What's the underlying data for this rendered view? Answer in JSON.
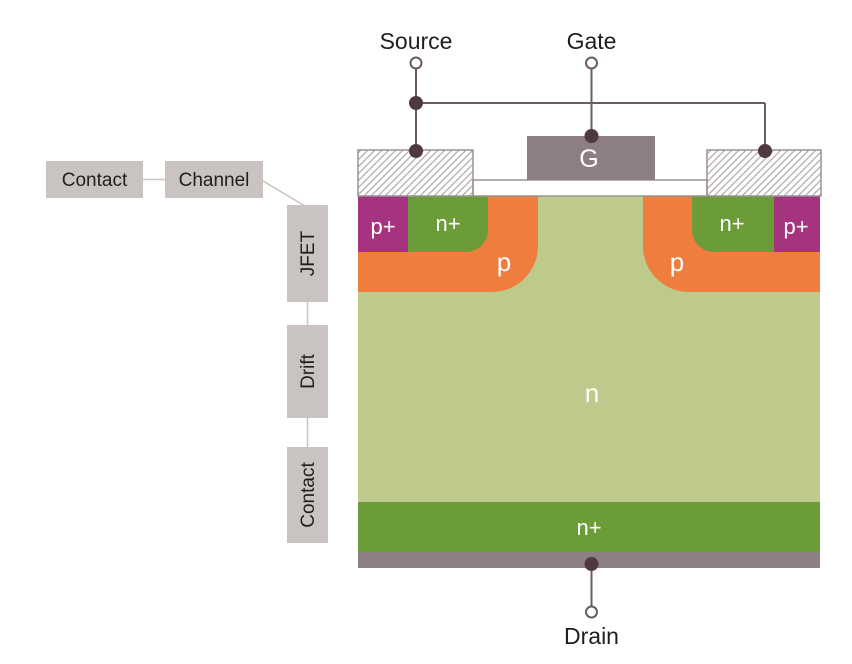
{
  "diagram": {
    "terminals": {
      "source": {
        "label": "Source"
      },
      "gate": {
        "label": "Gate",
        "electrode_label": "G"
      },
      "drain": {
        "label": "Drain"
      }
    },
    "regions": {
      "p_plus_left": "p+",
      "n_plus_left": "n+",
      "p_well_left": "p",
      "n_drift": "n",
      "p_well_right": "p",
      "n_plus_right": "n+",
      "p_plus_right": "p+",
      "n_plus_substrate": "n+"
    },
    "annotations": {
      "contact_top": "Contact",
      "channel": "Channel",
      "jfet": "JFET",
      "drift": "Drift",
      "contact_bottom": "Contact"
    },
    "colors": {
      "p_plus": "#A63380",
      "n_plus": "#6B9C38",
      "p_well": "#EF7D3E",
      "n_drift": "#BDCA8B",
      "substrate_metal": "#8D8083",
      "gate_electrode": "#8C7E81",
      "wire": "#6B5C60",
      "node": "#4F3940",
      "outline": "#9A9295",
      "hatch_stroke": "#B4ACAC",
      "annotation_box": "#C9C4C2",
      "connector_line": "#C9C3C1"
    }
  }
}
